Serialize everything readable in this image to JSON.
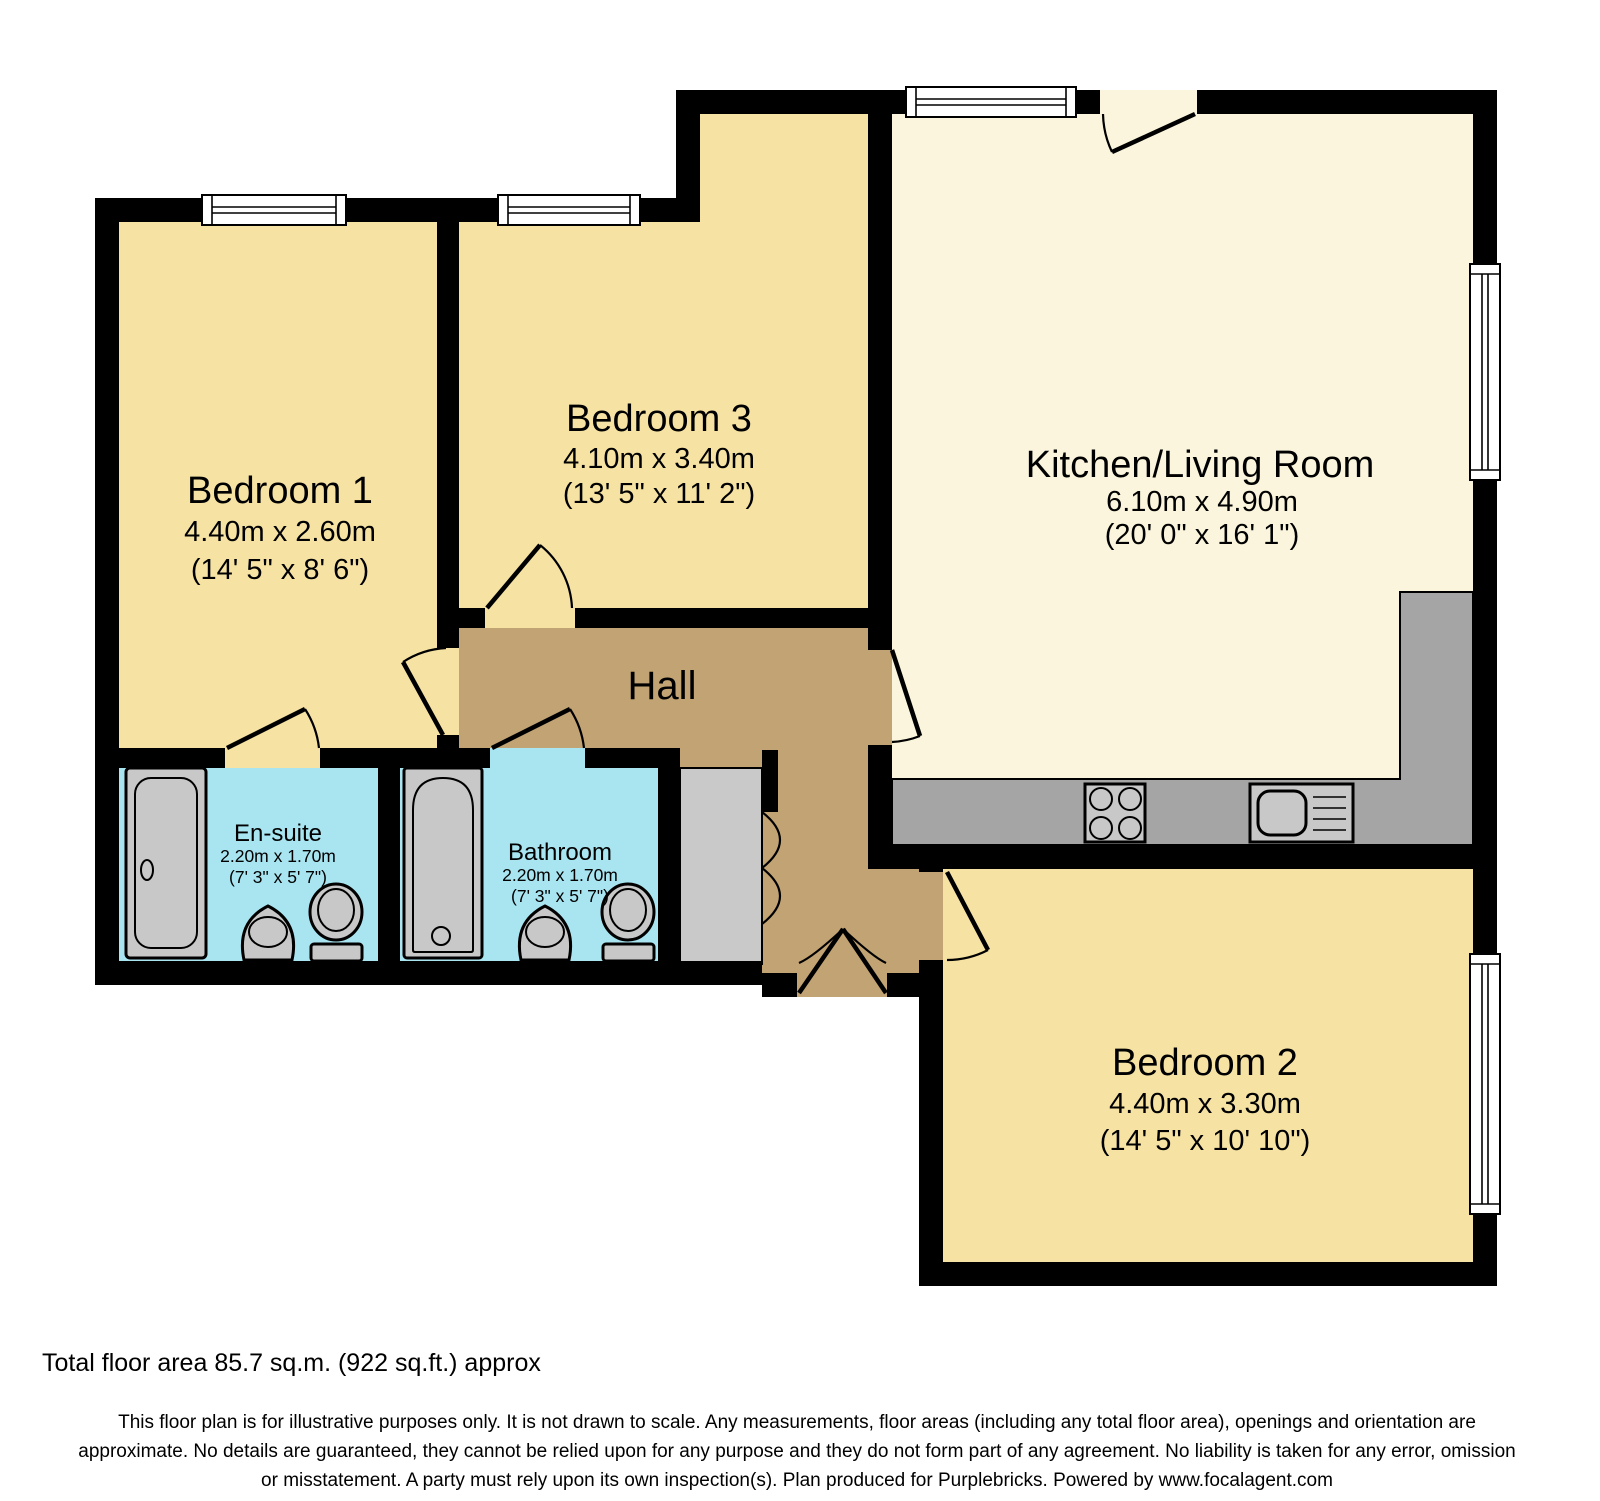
{
  "plan_title": "Floor plan",
  "colors": {
    "wall": "#000000",
    "room_yellow": "#F6E3A4",
    "kitchen_cream": "#FAF5DC",
    "hall_tan": "#C2A373",
    "bath_blue": "#A8E5F1",
    "cupboard_gray": "#C9C9C9",
    "counter_gray": "#A5A5A5",
    "fixture_gray": "#C8C8C8",
    "window_white": "#FFFFFF",
    "text": "#000000"
  },
  "rooms": {
    "bedroom1": {
      "name": "Bedroom 1",
      "metric": "4.40m x 2.60m",
      "imperial": "(14' 5\" x 8' 6\")"
    },
    "bedroom3": {
      "name": "Bedroom 3",
      "metric": "4.10m x 3.40m",
      "imperial": "(13' 5\" x 11' 2\")"
    },
    "kitchen": {
      "name": "Kitchen/Living Room",
      "metric": "6.10m x 4.90m",
      "imperial": "(20' 0\" x 16' 1\")"
    },
    "hall": {
      "name": "Hall"
    },
    "ensuite": {
      "name": "En-suite",
      "metric": "2.20m x 1.70m",
      "imperial": "(7' 3\" x 5' 7\")"
    },
    "bathroom": {
      "name": "Bathroom",
      "metric": "2.20m x 1.70m",
      "imperial": "(7' 3\" x 5' 7\")"
    },
    "bedroom2": {
      "name": "Bedroom 2",
      "metric": "4.40m x 3.30m",
      "imperial": "(14' 5\" x 10' 10\")"
    }
  },
  "symbols": {
    "bathtub": "bathtub",
    "toilet": "toilet",
    "basin": "basin",
    "hob": "4-ring hob",
    "sink": "sink with drainer",
    "window": "window",
    "door": "door swing",
    "cupboard": "cupboard with bi-fold doors",
    "entrance": "entrance double-swing door"
  },
  "footer": {
    "total_area": "Total floor area 85.7 sq.m. (922 sq.ft.) approx",
    "disclaimer_line1": "This floor plan is for illustrative purposes only. It is not drawn to scale. Any measurements, floor areas (including any total floor area), openings and orientation are",
    "disclaimer_line2": "approximate. No details are guaranteed, they cannot be relied upon for any purpose and they do not form part of any agreement. No liability is taken for any error, omission",
    "disclaimer_line3": "or misstatement. A party must rely upon its own inspection(s). Plan produced for Purplebricks. Powered by www.focalagent.com"
  }
}
